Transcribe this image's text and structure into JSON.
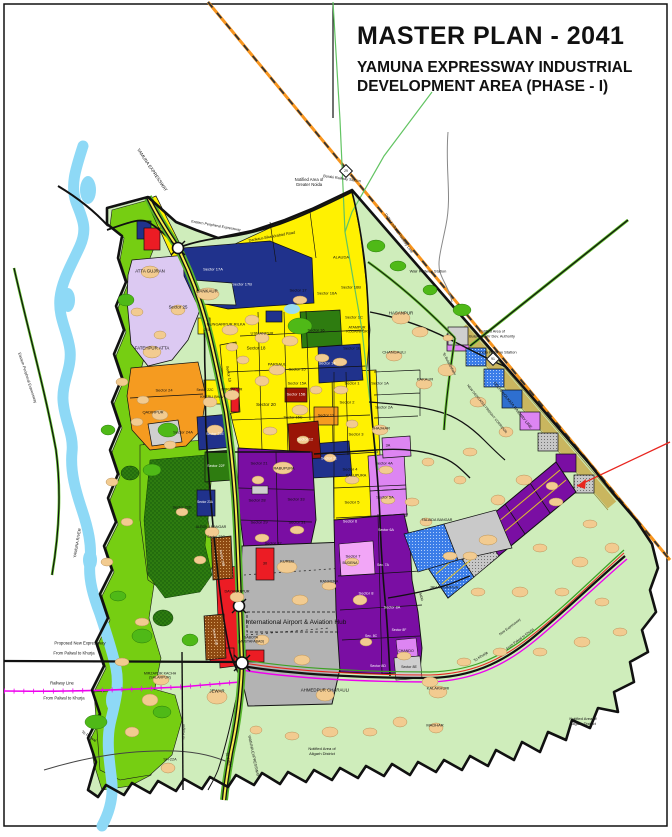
{
  "title": {
    "line1": "MASTER PLAN - 2041",
    "line2": "YAMUNA EXPRESSWAY INDUSTRIAL",
    "line3": "DEVELOPMENT AREA (PHASE - I)"
  },
  "colors": {
    "water": "#8ED9F6",
    "floodplain_green": "#76CE12",
    "rural_green": "#CFEDBB",
    "residential_yellow": "#FFF101",
    "institutional_navy": "#20328C",
    "industrial_purple": "#7A0EA3",
    "mixeduse_violet": "#DD85F2",
    "commercial_red": "#EC1C24",
    "darkred": "#9A1507",
    "orange": "#F59B20",
    "airport_gray": "#B3B3B3",
    "lavender": "#DCC9F2",
    "village_tan": "#F2CB90",
    "railway_orange": "#F7941D",
    "railway_magenta": "#EE00EE",
    "forest_green": "#2E7C10"
  },
  "map": {
    "signs": [
      {
        "label": "29",
        "x": 346,
        "y": 171
      },
      {
        "label": "91",
        "x": 493,
        "y": 359
      }
    ],
    "labels": [
      {
        "t": "YAMUNA EXPRESSWAY",
        "x": 152,
        "y": 170,
        "s": 4.5,
        "r": 56
      },
      {
        "t": "Notified Area of\nGreater Noida",
        "x": 309,
        "y": 182,
        "s": 4.2
      },
      {
        "t": "Boraki Railway Station",
        "x": 342,
        "y": 179,
        "s": 3.8,
        "r": 8
      },
      {
        "t": "Eastern Peripheral Expressway",
        "x": 216,
        "y": 226,
        "s": 3.6,
        "r": 10
      },
      {
        "t": "Dankaur-Sikandrabad Road",
        "x": 272,
        "y": 237,
        "s": 3.8,
        "r": -10
      },
      {
        "t": "Delhi Kolkata Railway Line",
        "x": 399,
        "y": 233,
        "s": 4,
        "r": 55
      },
      {
        "t": "ALAUDA",
        "x": 341,
        "y": 257,
        "s": 4
      },
      {
        "t": "ATTA GUJRAN",
        "x": 150,
        "y": 271,
        "s": 4.4
      },
      {
        "t": "Sector 17A",
        "x": 213,
        "y": 269,
        "s": 4,
        "c": "#fff"
      },
      {
        "t": "Sector 17B",
        "x": 242,
        "y": 284,
        "s": 4,
        "c": "#fff"
      },
      {
        "t": "DANKAUR",
        "x": 207,
        "y": 291,
        "s": 4.4
      },
      {
        "t": "Wair Railway Station",
        "x": 428,
        "y": 271,
        "s": 4
      },
      {
        "t": "Sector 25",
        "x": 178,
        "y": 307,
        "s": 4.4
      },
      {
        "t": "Sector 17",
        "x": 298,
        "y": 290,
        "s": 4
      },
      {
        "t": "Sector 16A",
        "x": 327,
        "y": 293,
        "s": 4
      },
      {
        "t": "Sector 16B",
        "x": 351,
        "y": 287,
        "s": 4
      },
      {
        "t": "HASANPUR",
        "x": 401,
        "y": 313,
        "s": 4.4
      },
      {
        "t": "DUNGARPUR RILKA",
        "x": 226,
        "y": 324,
        "s": 4
      },
      {
        "t": "USMANPUR",
        "x": 262,
        "y": 333,
        "s": 4
      },
      {
        "t": "Sector 16",
        "x": 316,
        "y": 330,
        "s": 4
      },
      {
        "t": "Sector 1C",
        "x": 354,
        "y": 317,
        "s": 4
      },
      {
        "t": "ATAMPUR\nKODAINPUR",
        "x": 357,
        "y": 330,
        "s": 3.6
      },
      {
        "t": "Notified Area of\nBulandshahr Dev. Authority",
        "x": 492,
        "y": 334,
        "s": 3.8
      },
      {
        "t": "FATEHPUR ATTA",
        "x": 152,
        "y": 348,
        "s": 4.4
      },
      {
        "t": "Sector 18",
        "x": 256,
        "y": 348,
        "s": 4.4
      },
      {
        "t": "Sector 1B",
        "x": 352,
        "y": 348,
        "s": 4
      },
      {
        "t": "CHANGAULI",
        "x": 394,
        "y": 352,
        "s": 4
      },
      {
        "t": "Chola Railway Station",
        "x": 497,
        "y": 352,
        "s": 4
      },
      {
        "t": "To Bulandshahr",
        "x": 449,
        "y": 364,
        "s": 3.6,
        "r": 62
      },
      {
        "t": "PARSAUL",
        "x": 277,
        "y": 364,
        "s": 4
      },
      {
        "t": "Sector 14",
        "x": 327,
        "y": 363,
        "s": 4,
        "c": "#fff"
      },
      {
        "t": "Sector 15",
        "x": 297,
        "y": 369,
        "s": 4
      },
      {
        "t": "Sector 19",
        "x": 228,
        "y": 374,
        "s": 3.8,
        "r": 80
      },
      {
        "t": "KAKAUR",
        "x": 425,
        "y": 379,
        "s": 4
      },
      {
        "t": "Sector 15A",
        "x": 297,
        "y": 384,
        "s": 3.8
      },
      {
        "t": "Sector 1",
        "x": 352,
        "y": 383,
        "s": 4
      },
      {
        "t": "Sector 1A",
        "x": 380,
        "y": 383,
        "s": 4
      },
      {
        "t": "MIRZAPUR",
        "x": 232,
        "y": 389,
        "s": 4
      },
      {
        "t": "Sector 24",
        "x": 164,
        "y": 390,
        "s": 4
      },
      {
        "t": "Sector 22C",
        "x": 205,
        "y": 390,
        "s": 3.4
      },
      {
        "t": "Sector 15B",
        "x": 296,
        "y": 395,
        "s": 3.8,
        "c": "#fff"
      },
      {
        "t": "KHERLI BHAV",
        "x": 212,
        "y": 397,
        "s": 3.6
      },
      {
        "t": "Sector 2",
        "x": 347,
        "y": 402,
        "s": 4
      },
      {
        "t": "Sector 20",
        "x": 266,
        "y": 405,
        "s": 4.6
      },
      {
        "t": "Sector 2A",
        "x": 384,
        "y": 407,
        "s": 4
      },
      {
        "t": "DELHI KOLKATA RAILWAY LINE",
        "x": 513,
        "y": 405,
        "s": 4,
        "r": 51
      },
      {
        "t": "NEW DEDICATED FREIGHT CORRIDOR",
        "x": 487,
        "y": 409,
        "s": 3.3,
        "r": 51
      },
      {
        "t": "QADIRPUR",
        "x": 153,
        "y": 412,
        "s": 4
      },
      {
        "t": "Sector 13",
        "x": 326,
        "y": 416,
        "s": 3.8
      },
      {
        "t": "Sector 15C",
        "x": 293,
        "y": 418,
        "s": 3.8
      },
      {
        "t": "JHAJHAR",
        "x": 381,
        "y": 428,
        "s": 4
      },
      {
        "t": "Sector 24A",
        "x": 183,
        "y": 432,
        "s": 4
      },
      {
        "t": "Sector 3",
        "x": 356,
        "y": 434,
        "s": 4
      },
      {
        "t": "Sector 22E",
        "x": 215,
        "y": 434,
        "s": 3.6,
        "c": "#fff"
      },
      {
        "t": "Sector 12",
        "x": 305,
        "y": 440,
        "s": 3.8,
        "c": "#fff"
      },
      {
        "t": "3A",
        "x": 388,
        "y": 446,
        "s": 3.8
      },
      {
        "t": "Sector 11",
        "x": 329,
        "y": 459,
        "s": 3.8,
        "c": "#fff"
      },
      {
        "t": "Sector 21",
        "x": 259,
        "y": 463,
        "s": 4
      },
      {
        "t": "Sector 4A",
        "x": 384,
        "y": 463,
        "s": 4
      },
      {
        "t": "Sector 22F",
        "x": 216,
        "y": 466,
        "s": 3.6,
        "c": "#fff"
      },
      {
        "t": "RABUPURA",
        "x": 284,
        "y": 469,
        "s": 3.8
      },
      {
        "t": "Sector 4",
        "x": 350,
        "y": 469,
        "s": 4
      },
      {
        "t": "KALUPURA",
        "x": 356,
        "y": 476,
        "s": 3.8
      },
      {
        "t": "Sector 5A",
        "x": 385,
        "y": 497,
        "s": 4
      },
      {
        "t": "Sector 28",
        "x": 257,
        "y": 500,
        "s": 4
      },
      {
        "t": "Sector 33",
        "x": 296,
        "y": 499,
        "s": 4
      },
      {
        "t": "Sector 5",
        "x": 352,
        "y": 502,
        "s": 4
      },
      {
        "t": "Sector 23A",
        "x": 205,
        "y": 502,
        "s": 3.2,
        "c": "#fff"
      },
      {
        "t": "Sector 23D",
        "x": 182,
        "y": 508,
        "s": 3.8
      },
      {
        "t": "FALAIDA BANGAR",
        "x": 437,
        "y": 520,
        "s": 3.6
      },
      {
        "t": "Sector 29",
        "x": 259,
        "y": 522,
        "s": 4
      },
      {
        "t": "Sector 31",
        "x": 297,
        "y": 522,
        "s": 4
      },
      {
        "t": "Sector 6",
        "x": 350,
        "y": 522,
        "s": 3.8,
        "c": "#fff"
      },
      {
        "t": "ALEDHA NANGAR",
        "x": 211,
        "y": 527,
        "s": 3.6
      },
      {
        "t": "Sector 6A",
        "x": 386,
        "y": 530,
        "s": 3.6,
        "c": "#fff"
      },
      {
        "t": "Sector 23C",
        "x": 216,
        "y": 537,
        "s": 3.6
      },
      {
        "t": "Sector 32",
        "x": 273,
        "y": 543,
        "s": 4
      },
      {
        "t": "Sector 7",
        "x": 353,
        "y": 556,
        "s": 4
      },
      {
        "t": "Sector 23B",
        "x": 222,
        "y": 558,
        "s": 3.4,
        "r": 80,
        "c": "#fff"
      },
      {
        "t": "KUREB",
        "x": 287,
        "y": 561,
        "s": 4
      },
      {
        "t": "BUDENA",
        "x": 350,
        "y": 563,
        "s": 3.6
      },
      {
        "t": "Sec. 7A",
        "x": 383,
        "y": 565,
        "s": 3.4,
        "c": "#fff"
      },
      {
        "t": "30",
        "x": 265,
        "y": 564,
        "s": 3.8
      },
      {
        "t": "RANHERA",
        "x": 329,
        "y": 582,
        "s": 3.8
      },
      {
        "t": "JAHANGIRPUR",
        "x": 444,
        "y": 587,
        "s": 4
      },
      {
        "t": "DAYANATPUR",
        "x": 237,
        "y": 592,
        "s": 3.8
      },
      {
        "t": "Sector 8",
        "x": 366,
        "y": 593,
        "s": 4,
        "c": "#fff"
      },
      {
        "t": "MDR",
        "x": 421,
        "y": 597,
        "s": 3.4,
        "r": 75
      },
      {
        "t": "Sector 8A",
        "x": 392,
        "y": 608,
        "s": 3.8,
        "c": "#fff"
      },
      {
        "t": "International Airport & Aviation Hub",
        "x": 296,
        "y": 623,
        "s": 6.5
      },
      {
        "t": "New Expressway",
        "x": 510,
        "y": 627,
        "s": 3.4,
        "r": -37
      },
      {
        "t": "Sector 8F",
        "x": 399,
        "y": 630,
        "s": 3.4,
        "c": "#fff"
      },
      {
        "t": "Sec. 8C",
        "x": 371,
        "y": 636,
        "s": 3.4,
        "c": "#fff"
      },
      {
        "t": "Sector 22B",
        "x": 215,
        "y": 637,
        "s": 3.4,
        "r": 80,
        "c": "#fff"
      },
      {
        "t": "From Palwal to Khurja",
        "x": 520,
        "y": 639,
        "s": 3.4,
        "r": -37
      },
      {
        "t": "SABOTA\n(MUSTAFABAD)",
        "x": 251,
        "y": 640,
        "s": 3.6
      },
      {
        "t": "Proposed New Expressway",
        "x": 80,
        "y": 643,
        "s": 4.2
      },
      {
        "t": "From Palwal to Khurja",
        "x": 74,
        "y": 653,
        "s": 4.2
      },
      {
        "t": "CHANDO",
        "x": 406,
        "y": 651,
        "s": 3.6
      },
      {
        "t": "To Khurja",
        "x": 481,
        "y": 657,
        "s": 3.8,
        "r": -33
      },
      {
        "t": "Sector 8D",
        "x": 378,
        "y": 666,
        "s": 3.6,
        "c": "#fff"
      },
      {
        "t": "Sector 8E",
        "x": 409,
        "y": 667,
        "s": 3.6
      },
      {
        "t": "MIRZAPUR KACHH\n(SALARPUR)",
        "x": 160,
        "y": 676,
        "s": 3.6
      },
      {
        "t": "Railway Line",
        "x": 62,
        "y": 683,
        "s": 4.2
      },
      {
        "t": "KALAKHURI",
        "x": 438,
        "y": 688,
        "s": 4
      },
      {
        "t": "AHMEDPUR CHARAULI",
        "x": 325,
        "y": 690,
        "s": 4.4
      },
      {
        "t": "JEWAR",
        "x": 217,
        "y": 691,
        "s": 4.4
      },
      {
        "t": "From Palwal to Khurja",
        "x": 64,
        "y": 698,
        "s": 4.2
      },
      {
        "t": "Notified Area of\nAligarh District",
        "x": 583,
        "y": 721,
        "s": 4
      },
      {
        "t": "MADHAR",
        "x": 435,
        "y": 725,
        "s": 4
      },
      {
        "t": "To Raipur",
        "x": 184,
        "y": 732,
        "s": 3.8,
        "r": -90
      },
      {
        "t": "To Palwal",
        "x": 89,
        "y": 736,
        "s": 4,
        "r": 35
      },
      {
        "t": "Notified Area of\nAligarh District",
        "x": 322,
        "y": 751,
        "s": 4
      },
      {
        "t": "YAMUNA EXPRESSWAY",
        "x": 253,
        "y": 756,
        "s": 3.8,
        "r": 78
      },
      {
        "t": "To Jattari",
        "x": 228,
        "y": 760,
        "s": 3.8,
        "r": 75
      },
      {
        "t": "SH-22A",
        "x": 170,
        "y": 760,
        "s": 3.8
      },
      {
        "t": "YAMUNA RIVER",
        "x": 77,
        "y": 543,
        "s": 4,
        "r": -80
      },
      {
        "t": "Eastern Peripheral Expressway",
        "x": 27,
        "y": 378,
        "s": 3.8,
        "r": 72
      },
      {
        "t": "22A",
        "x": 207,
        "y": 330,
        "s": 3.2
      }
    ]
  }
}
